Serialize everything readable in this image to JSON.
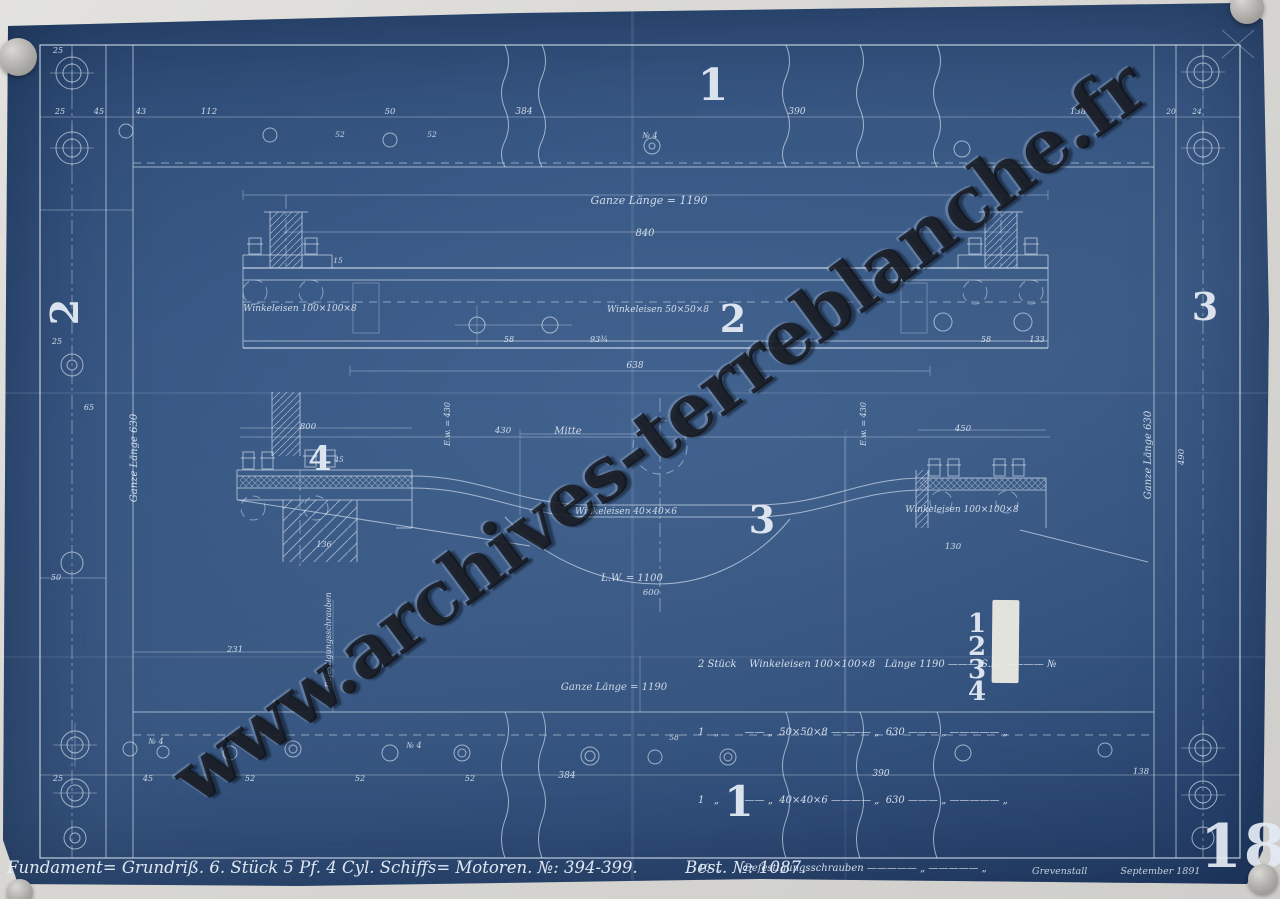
{
  "title_block": {
    "title": "Fundament= Grundriß.   6. Stück   5 Pf. 4 Cyl.   Schiffs= Motoren.   №: 394-399.",
    "order_no": "Best. №: 1087.",
    "place": "Grevenstall",
    "date": "September 1891",
    "sheet_number": "18"
  },
  "watermark": {
    "text": "www.archives-terreblanche.fr"
  },
  "parts_list": {
    "rows": [
      {
        "line": "2 Stück    Winkeleisen 100×100×8   Länge 1190 ——— S.L. ———— №",
        "num": "1"
      },
      {
        "line": "1   „        —— „  50×50×8 ———— „  630 ——— „ ————— „",
        "num": "2"
      },
      {
        "line": "1   „        —— „  40×40×6 ———— „  630 ——— „ ————— „",
        "num": "3"
      },
      {
        "line": "10  „       Befestigungsschrauben ————— „ ————— „",
        "num": "4"
      }
    ]
  },
  "svg_texts": [
    {
      "t": "1",
      "x": 713,
      "y": 100,
      "s": 44,
      "c": "num",
      "n": "view-label-1-top"
    },
    {
      "t": "2",
      "x": 733,
      "y": 332,
      "s": 38,
      "c": "num",
      "n": "view-label-2"
    },
    {
      "t": "3",
      "x": 762,
      "y": 533,
      "s": 38,
      "c": "num",
      "n": "view-label-3"
    },
    {
      "t": "4",
      "x": 320,
      "y": 470,
      "s": 34,
      "c": "num",
      "n": "view-label-4"
    },
    {
      "t": "1",
      "x": 739,
      "y": 816,
      "s": 42,
      "c": "num",
      "n": "view-label-1-bottom"
    },
    {
      "t": "2",
      "x": 78,
      "y": 312,
      "s": 38,
      "r": -90,
      "c": "num",
      "n": "side-label-2-left"
    },
    {
      "t": "3",
      "x": 1205,
      "y": 320,
      "s": 38,
      "c": "num",
      "n": "side-label-3-right"
    },
    {
      "t": "1",
      "x": 977,
      "y": 632,
      "s": 26,
      "c": "num",
      "n": "parts-item-no-1"
    },
    {
      "t": "2",
      "x": 977,
      "y": 655,
      "s": 26,
      "c": "num",
      "n": "parts-item-no-2"
    },
    {
      "t": "3",
      "x": 977,
      "y": 678,
      "s": 26,
      "c": "num",
      "n": "parts-item-no-3"
    },
    {
      "t": "4",
      "x": 977,
      "y": 700,
      "s": 26,
      "c": "num",
      "n": "parts-item-no-4"
    },
    {
      "t": "Ganze Länge = 1190",
      "x": 649,
      "y": 204,
      "s": 11,
      "n": "label-ganze-laenge-top"
    },
    {
      "t": "840",
      "x": 645,
      "y": 236,
      "s": 10,
      "n": "dim-840"
    },
    {
      "t": "Winkeleisen 100×100×8",
      "x": 300,
      "y": 311,
      "s": 9,
      "n": "label-winkeleisen-100-left"
    },
    {
      "t": "Winkeleisen 50×50×8",
      "x": 658,
      "y": 312,
      "s": 9,
      "n": "label-winkeleisen-50"
    },
    {
      "t": "Winkeleisen 40×40×6",
      "x": 626,
      "y": 514,
      "s": 9,
      "n": "label-winkeleisen-40"
    },
    {
      "t": "Winkeleisen 100×100×8",
      "x": 962,
      "y": 512,
      "s": 9,
      "n": "label-winkeleisen-100-right"
    },
    {
      "t": "Mitte",
      "x": 568,
      "y": 434,
      "s": 10,
      "n": "label-mitte"
    },
    {
      "t": "L.W. = 1100",
      "x": 632,
      "y": 581,
      "s": 10,
      "n": "label-lichte-weite"
    },
    {
      "t": "E.w. = 430",
      "x": 450,
      "y": 424,
      "s": 8,
      "r": -90,
      "n": "label-ew-left"
    },
    {
      "t": "E.w. = 430",
      "x": 866,
      "y": 424,
      "s": 8,
      "r": -90,
      "n": "label-ew-right"
    },
    {
      "t": "Ganze Länge 630",
      "x": 137,
      "y": 458,
      "s": 10,
      "r": -90,
      "n": "label-ganze-laenge-left"
    },
    {
      "t": "Ganze Länge 630",
      "x": 1151,
      "y": 455,
      "s": 10,
      "r": -90,
      "n": "label-ganze-laenge-right"
    },
    {
      "t": "Ganze Länge = 1190",
      "x": 614,
      "y": 690,
      "s": 10,
      "n": "label-ganze-laenge-bottom"
    },
    {
      "t": "Befestigungsschrauben",
      "x": 331,
      "y": 640,
      "s": 8,
      "r": -90,
      "n": "label-befestigungsschrauben"
    },
    {
      "t": "№ 4",
      "x": 650,
      "y": 138,
      "s": 8,
      "n": "label-no4-top"
    },
    {
      "t": "№ 4",
      "x": 156,
      "y": 744,
      "s": 8,
      "n": "label-no4-bottom-a"
    },
    {
      "t": "№ 4",
      "x": 414,
      "y": 748,
      "s": 8,
      "n": "label-no4-bottom-b"
    },
    {
      "t": "25",
      "x": 58,
      "y": 53,
      "s": 8,
      "n": "dim"
    },
    {
      "t": "25",
      "x": 60,
      "y": 114,
      "s": 8,
      "n": "dim"
    },
    {
      "t": "45",
      "x": 99,
      "y": 114,
      "s": 8,
      "n": "dim"
    },
    {
      "t": "43",
      "x": 141,
      "y": 114,
      "s": 8,
      "n": "dim"
    },
    {
      "t": "112",
      "x": 209,
      "y": 114,
      "s": 8.5,
      "n": "dim"
    },
    {
      "t": "50",
      "x": 390,
      "y": 114,
      "s": 8.5,
      "n": "dim"
    },
    {
      "t": "384",
      "x": 524,
      "y": 114,
      "s": 9,
      "n": "dim"
    },
    {
      "t": "390",
      "x": 797,
      "y": 114,
      "s": 9,
      "n": "dim"
    },
    {
      "t": "138",
      "x": 1078,
      "y": 114,
      "s": 8.5,
      "n": "dim"
    },
    {
      "t": "20",
      "x": 1171,
      "y": 114,
      "s": 7.5,
      "n": "dim"
    },
    {
      "t": "24",
      "x": 1197,
      "y": 114,
      "s": 7.5,
      "n": "dim"
    },
    {
      "t": "52",
      "x": 340,
      "y": 137,
      "s": 7.5,
      "n": "dim"
    },
    {
      "t": "52",
      "x": 432,
      "y": 137,
      "s": 7.5,
      "n": "dim"
    },
    {
      "t": "25",
      "x": 57,
      "y": 344,
      "s": 8,
      "n": "dim"
    },
    {
      "t": "65",
      "x": 89,
      "y": 410,
      "s": 8,
      "n": "dim"
    },
    {
      "t": "50",
      "x": 56,
      "y": 580,
      "s": 8,
      "n": "dim"
    },
    {
      "t": "231",
      "x": 235,
      "y": 652,
      "s": 8.5,
      "n": "dim"
    },
    {
      "t": "638",
      "x": 635,
      "y": 368,
      "s": 9,
      "n": "dim"
    },
    {
      "t": "58",
      "x": 509,
      "y": 342,
      "s": 8,
      "n": "dim"
    },
    {
      "t": "93¾",
      "x": 599,
      "y": 342,
      "s": 8,
      "n": "dim"
    },
    {
      "t": "58",
      "x": 986,
      "y": 342,
      "s": 8,
      "n": "dim"
    },
    {
      "t": "133",
      "x": 1037,
      "y": 342,
      "s": 8,
      "n": "dim"
    },
    {
      "t": "15",
      "x": 338,
      "y": 263,
      "s": 7.5,
      "n": "dim"
    },
    {
      "t": "430",
      "x": 503,
      "y": 433,
      "s": 8.5,
      "n": "dim"
    },
    {
      "t": "800",
      "x": 308,
      "y": 429,
      "s": 8.5,
      "n": "dim"
    },
    {
      "t": "450",
      "x": 963,
      "y": 431,
      "s": 8.5,
      "n": "dim"
    },
    {
      "t": "45",
      "x": 339,
      "y": 462,
      "s": 7.5,
      "n": "dim"
    },
    {
      "t": "136",
      "x": 324,
      "y": 547,
      "s": 8,
      "n": "dim"
    },
    {
      "t": "130",
      "x": 953,
      "y": 549,
      "s": 8.5,
      "n": "dim"
    },
    {
      "t": "600",
      "x": 651,
      "y": 595,
      "s": 8.5,
      "n": "dim"
    },
    {
      "t": "490",
      "x": 1184,
      "y": 457,
      "s": 8.5,
      "r": -90,
      "n": "dim"
    },
    {
      "t": "384",
      "x": 567,
      "y": 778,
      "s": 9,
      "n": "dim"
    },
    {
      "t": "390",
      "x": 881,
      "y": 776,
      "s": 9,
      "n": "dim"
    },
    {
      "t": "25",
      "x": 58,
      "y": 781,
      "s": 8,
      "n": "dim"
    },
    {
      "t": "45",
      "x": 148,
      "y": 781,
      "s": 8,
      "n": "dim"
    },
    {
      "t": "52",
      "x": 250,
      "y": 781,
      "s": 8,
      "n": "dim"
    },
    {
      "t": "52",
      "x": 360,
      "y": 781,
      "s": 8,
      "n": "dim"
    },
    {
      "t": "52",
      "x": 470,
      "y": 781,
      "s": 8,
      "n": "dim"
    },
    {
      "t": "58",
      "x": 674,
      "y": 740,
      "s": 7.5,
      "n": "dim"
    },
    {
      "t": "138",
      "x": 1141,
      "y": 774,
      "s": 8.5,
      "n": "dim"
    }
  ]
}
